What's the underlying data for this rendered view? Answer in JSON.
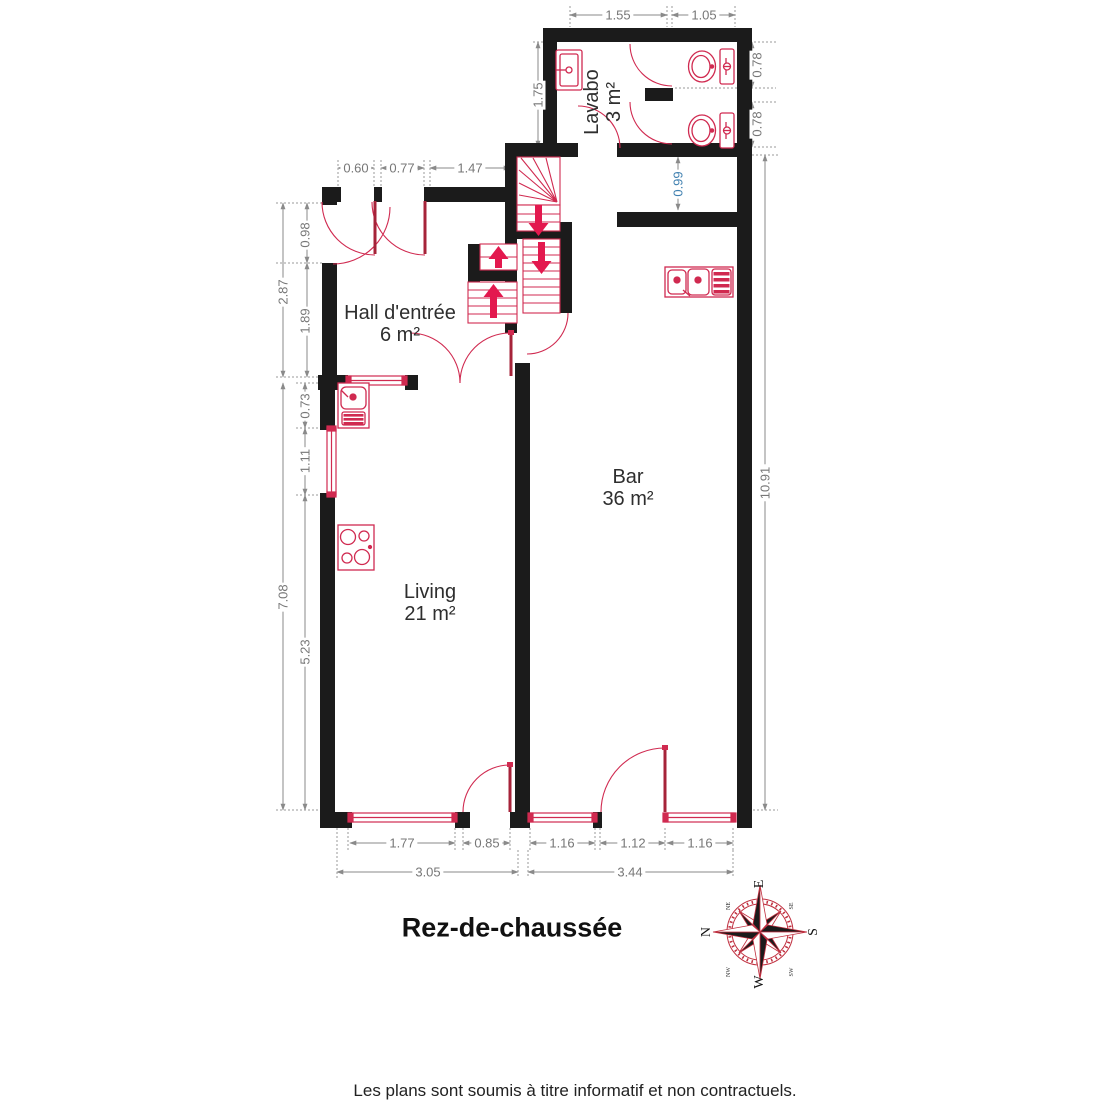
{
  "title": "Rez-de-chaussée",
  "disclaimer": "Les plans sont soumis à titre informatif et non contractuels.",
  "rooms": {
    "lavabo": {
      "name": "Lavabo",
      "area": "3 m²"
    },
    "hall": {
      "name": "Hall d'entrée",
      "area": "6 m²"
    },
    "bar": {
      "name": "Bar",
      "area": "36 m²"
    },
    "living": {
      "name": "Living",
      "area": "21 m²"
    }
  },
  "dims": {
    "top_1": "1.55",
    "top_2": "1.05",
    "lavabo_h": "1.75",
    "wc1_h": "0.78",
    "wc2_h": "0.78",
    "passage": "0.99",
    "hall_1": "0.60",
    "hall_2": "0.77",
    "hall_3": "1.47",
    "left_door": "0.98",
    "left_total_top": "2.87",
    "left_wall": "1.89",
    "left_sink": "0.73",
    "left_window": "1.11",
    "left_total_bottom": "7.08",
    "left_wall2": "5.23",
    "right_total": "10.91",
    "bottom_w1": "1.77",
    "bottom_d1": "0.85",
    "bottom_total_left": "3.05",
    "bottom_w2": "1.16",
    "bottom_d2": "1.12",
    "bottom_w3": "1.16",
    "bottom_total_right": "3.44"
  },
  "compass": {
    "n": "N",
    "e": "E",
    "s": "S",
    "w": "W",
    "ne": "NE",
    "se": "SE",
    "sw": "SW",
    "nw": "NW"
  },
  "colors": {
    "wall": "#1b1b1b",
    "fixture": "#d02a50",
    "arrow": "#e3184e",
    "dimension": "#8a8a8a",
    "dimension_blue": "#4080b0"
  }
}
